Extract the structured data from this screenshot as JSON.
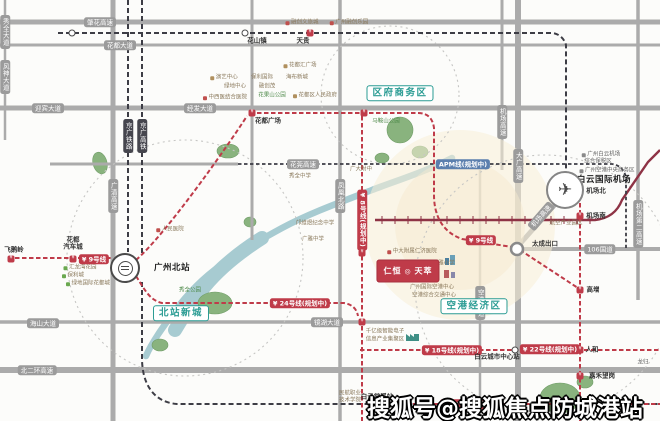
{
  "meta": {
    "watermark": "搜狐号@搜狐焦点防城港站"
  },
  "landmarks": {
    "airport": "白云国际机场",
    "north_station": "广州北站"
  },
  "project": {
    "name_left": "仁恒",
    "logo_mark": "◎",
    "name_right": "天萃"
  },
  "zones": [
    {
      "t": "区府商务区",
      "x": 400,
      "y": 93
    },
    {
      "t": "北站新城",
      "x": 181,
      "y": 313
    },
    {
      "t": "空港经济区",
      "x": 474,
      "y": 306
    }
  ],
  "road_pills": [
    {
      "t": "肇花高速",
      "x": 100,
      "y": 22
    },
    {
      "t": "花都大道",
      "x": 120,
      "y": 45
    },
    {
      "t": "迎宾大道",
      "x": 48,
      "y": 108
    },
    {
      "t": "经发大道",
      "x": 200,
      "y": 108
    },
    {
      "t": "秀全大道",
      "x": 5,
      "y": 32,
      "v": true
    },
    {
      "t": "风神大道",
      "x": 5,
      "y": 77,
      "v": true
    },
    {
      "t": "广清高速",
      "x": 113,
      "y": 196,
      "v": true
    },
    {
      "t": "凤凰北路",
      "x": 340,
      "y": 196,
      "v": true
    },
    {
      "t": "大广高速",
      "x": 518,
      "y": 166,
      "v": true
    },
    {
      "t": "机场高速",
      "x": 502,
      "y": 122,
      "v": true
    },
    {
      "t": "机场高速",
      "x": 541,
      "y": 216,
      "rot": -49
    },
    {
      "t": "花莞高速",
      "x": 303,
      "y": 164
    },
    {
      "t": "镜湖大道",
      "x": 327,
      "y": 322
    },
    {
      "t": "海山大道",
      "x": 43,
      "y": 323
    },
    {
      "t": "北二环高速",
      "x": 37,
      "y": 370
    },
    {
      "t": "机场第二高速",
      "x": 638,
      "y": 224,
      "v": true
    },
    {
      "t": "空港大道",
      "x": 480,
      "y": 303,
      "v": true
    },
    {
      "t": "106国道",
      "x": 600,
      "y": 249
    }
  ],
  "rail_pills": [
    {
      "t": "京广铁路",
      "x": 128,
      "y": 136
    },
    {
      "t": "京广高铁",
      "x": 142,
      "y": 136
    }
  ],
  "line_pills": [
    {
      "t": "9号线",
      "x": 94,
      "y": 259,
      "c": "red",
      "lg": true
    },
    {
      "t": "9号线",
      "x": 481,
      "y": 240,
      "c": "red",
      "lg": true
    },
    {
      "t": "24号线(规划中)",
      "x": 300,
      "y": 303,
      "c": "red",
      "lg": true
    },
    {
      "t": "8号线(规划中)",
      "x": 362,
      "y": 220,
      "c": "red",
      "v": true,
      "lg": true
    },
    {
      "t": "18号线(规划中)",
      "x": 452,
      "y": 350,
      "c": "red",
      "lg": true
    },
    {
      "t": "22号线(规划中)",
      "x": 550,
      "y": 349,
      "c": "red",
      "lg": true
    },
    {
      "t": "22号线(规划中)",
      "x": 470,
      "y": 404,
      "c": "red",
      "lg": true
    },
    {
      "t": "APM线(规划中)",
      "x": 463,
      "y": 164,
      "c": "blue"
    }
  ],
  "stations": [
    {
      "t": "飞鹅岭",
      "b": "m",
      "x": 11,
      "y": 259,
      "lx": 14,
      "ly": 250
    },
    {
      "t": "花都\n汽车城",
      "b": "m",
      "x": 73,
      "y": 259,
      "lx": 73,
      "ly": 244
    },
    {
      "t": "花都广场",
      "b": "m",
      "x": 252,
      "y": 113,
      "lx": 268,
      "ly": 121
    },
    {
      "t": "",
      "b": "m",
      "x": 364,
      "y": 113
    },
    {
      "t": "天贵",
      "b": "m",
      "x": 310,
      "y": 33,
      "lx": 303,
      "ly": 41
    },
    {
      "t": "花山镇",
      "b": "c",
      "x": 245,
      "y": 33,
      "lx": 257,
      "ly": 41
    },
    {
      "t": "",
      "b": "c",
      "x": 72,
      "y": 33
    },
    {
      "t": "机场北",
      "b": "m",
      "x": 580,
      "y": 191,
      "lx": 596,
      "ly": 191
    },
    {
      "t": "机场南",
      "b": "m",
      "x": 580,
      "y": 216,
      "lx": 596,
      "ly": 216
    },
    {
      "t": "高增",
      "b": "m",
      "x": 580,
      "y": 290,
      "lx": 593,
      "ly": 290
    },
    {
      "t": "人和",
      "b": "m",
      "x": 580,
      "y": 350,
      "lx": 592,
      "ly": 350
    },
    {
      "t": "嘉禾望岗",
      "b": "m",
      "x": 580,
      "y": 376,
      "lx": 602,
      "ly": 376
    },
    {
      "t": "白云城市中心站",
      "b": "c",
      "x": 515,
      "y": 350,
      "lx": 497,
      "ly": 357
    },
    {
      "t": "白云棠溪站",
      "b": "c",
      "x": 375,
      "y": 404,
      "lx": 377,
      "ly": 397
    },
    {
      "t": "",
      "b": "m",
      "x": 384,
      "y": 404
    },
    {
      "t": "",
      "b": "m",
      "x": 362,
      "y": 253
    },
    {
      "t": "",
      "b": "m",
      "x": 362,
      "y": 322
    },
    {
      "t": "太成出口",
      "b": "n",
      "x": 0,
      "y": 0,
      "lx": 545,
      "ly": 244
    }
  ],
  "pois": [
    {
      "t": "融创文旅城",
      "x": 302,
      "y": 23,
      "ic": "#c0504d"
    },
    {
      "t": "广州融创乐园",
      "x": 349,
      "y": 23,
      "ic": "#c0504d"
    },
    {
      "t": "花都汇广场",
      "x": 300,
      "y": 66,
      "ic": "#b0905e"
    },
    {
      "t": "演艺中心",
      "x": 224,
      "y": 78,
      "ic": "#b0905e"
    },
    {
      "t": "保利国际",
      "x": 262,
      "y": 78
    },
    {
      "t": "海布新城",
      "x": 297,
      "y": 78
    },
    {
      "t": "绿地中心",
      "x": 235,
      "y": 87
    },
    {
      "t": "融创茂",
      "x": 267,
      "y": 87
    },
    {
      "t": "中西医结合医院",
      "x": 225,
      "y": 98,
      "ic": "#c0504d"
    },
    {
      "t": "花果山公园",
      "x": 272,
      "y": 96,
      "c": "green"
    },
    {
      "t": "花都区人民政府",
      "x": 315,
      "y": 96,
      "ic": "#b0905e"
    },
    {
      "t": "人民医院",
      "x": 170,
      "y": 230,
      "ic": "#c0504d"
    },
    {
      "t": "秀全中学",
      "x": 300,
      "y": 177
    },
    {
      "t": "广大附中",
      "x": 361,
      "y": 170
    },
    {
      "t": "邝维煜纪念中学",
      "x": 315,
      "y": 224
    },
    {
      "t": "广雅中学",
      "x": 313,
      "y": 240
    },
    {
      "t": "秀全公园",
      "x": 190,
      "y": 291,
      "c": "green"
    },
    {
      "t": "马鞍山公园",
      "x": 386,
      "y": 122,
      "c": "green"
    },
    {
      "t": "汇龙湾花园",
      "x": 80,
      "y": 268,
      "ic": "#6aa84f"
    },
    {
      "t": "保利城",
      "x": 73,
      "y": 276,
      "ic": "#6aa84f"
    },
    {
      "t": "绿地国际花都城",
      "x": 88,
      "y": 284,
      "ic": "#6aa84f"
    },
    {
      "t": "中大附属仁济医院",
      "x": 412,
      "y": 252,
      "ic": "#c0504d"
    },
    {
      "t": "新雅小学",
      "x": 441,
      "y": 264,
      "ic": "#5b7fae"
    },
    {
      "t": "广州国际空港中心",
      "x": 432,
      "y": 288
    },
    {
      "t": "空港综合交通中心",
      "x": 434,
      "y": 296
    },
    {
      "t": "千亿级智能电子",
      "x": 385,
      "y": 332
    },
    {
      "t": "信息产业集聚区",
      "x": 385,
      "y": 340
    },
    {
      "t": "航空产业园区",
      "x": 566,
      "y": 224
    },
    {
      "t": "广州白云机场",
      "x": 601,
      "y": 155,
      "c": "gray",
      "ic": "#8a8a8a"
    },
    {
      "t": "综合保税区",
      "x": 598,
      "y": 162,
      "c": "gray"
    },
    {
      "t": "广州空港中央商务区",
      "x": 607,
      "y": 171,
      "c": "gray",
      "ic": "#8a8a8a"
    },
    {
      "t": "民航职业",
      "x": 350,
      "y": 394
    },
    {
      "t": "技术学院",
      "x": 350,
      "y": 401
    },
    {
      "t": "龙归",
      "x": 643,
      "y": 363,
      "c": "gray"
    }
  ]
}
